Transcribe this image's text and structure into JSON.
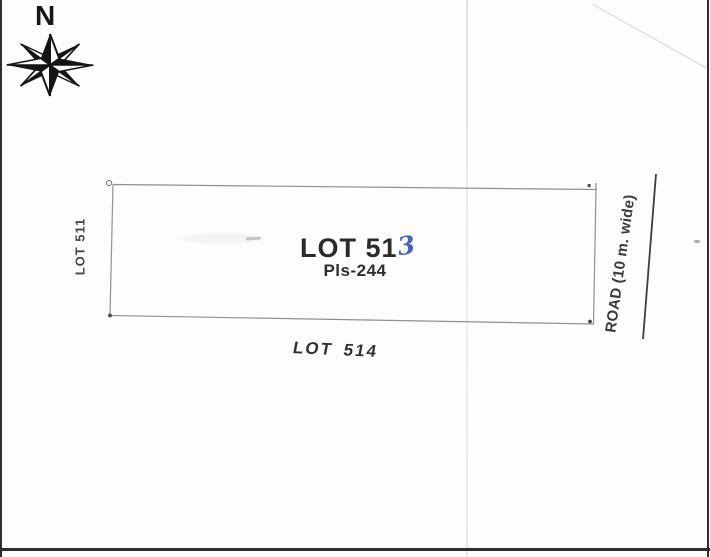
{
  "compass": {
    "north_label": "N"
  },
  "lot": {
    "label_printed": "LOT 51",
    "handwritten_digit": "3",
    "plan_number": "Pls-244"
  },
  "neighbors": {
    "west": "LOT 511",
    "south": "LOT 514",
    "east": "ROAD (10 m. wide)"
  },
  "colors": {
    "ink": "#2b2b2b",
    "handwriting_blue": "#4066c0",
    "boundary_gray": "#919191",
    "road_line": "#3f3f3f",
    "page_edge": "#2e2e2e"
  }
}
